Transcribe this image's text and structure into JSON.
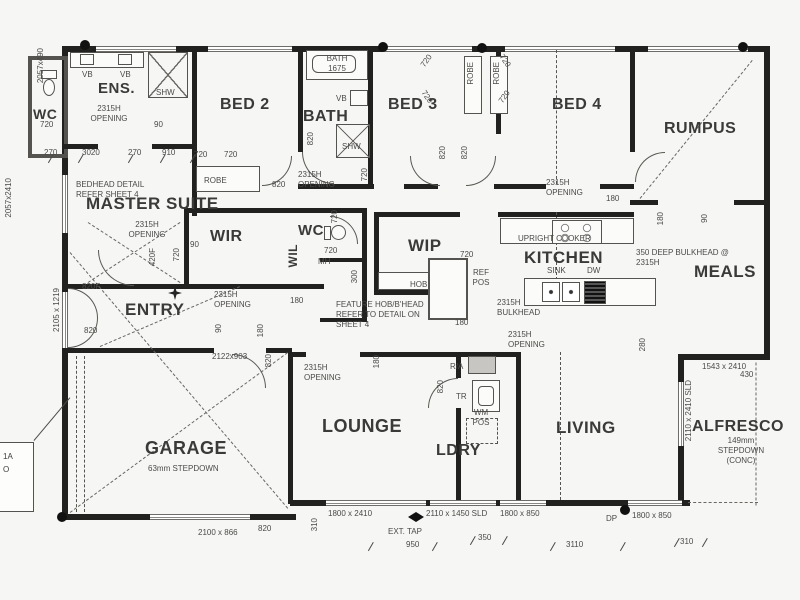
{
  "drawing": {
    "type": "residential floor plan",
    "colors": {
      "paper": "#f6f6f4",
      "wall": "#21211f",
      "text": "#3d3d3d",
      "thin_line": "#55534f"
    }
  },
  "rooms": {
    "wc1": {
      "label": "WC"
    },
    "ens": {
      "label": "ENS."
    },
    "bed2": {
      "label": "BED 2"
    },
    "bath": {
      "label": "BATH"
    },
    "bed3": {
      "label": "BED 3"
    },
    "bed4": {
      "label": "BED 4"
    },
    "rumpus": {
      "label": "RUMPUS"
    },
    "master": {
      "label": "MASTER SUITE"
    },
    "wir": {
      "label": "WIR"
    },
    "wc2": {
      "label": "WC"
    },
    "wil": {
      "label": "WIL"
    },
    "wip": {
      "label": "WIP"
    },
    "kitchen": {
      "label": "KITCHEN"
    },
    "meals": {
      "label": "MEALS"
    },
    "entry": {
      "label": "ENTRY"
    },
    "garage": {
      "label": "GARAGE"
    },
    "lounge": {
      "label": "LOUNGE"
    },
    "ldry": {
      "label": "LDRY"
    },
    "living": {
      "label": "LIVING"
    },
    "alfresco": {
      "label": "ALFRESCO"
    }
  },
  "edge_note": {
    "line1": "1A",
    "line2": "O"
  },
  "annotations": [
    {
      "id": "dim-2057x490",
      "text": "2057x490",
      "x": 36,
      "y": 48,
      "vert": true
    },
    {
      "id": "vb-ens-1",
      "text": "VB",
      "x": 82,
      "y": 70
    },
    {
      "id": "vb-ens-2",
      "text": "VB",
      "x": 120,
      "y": 70
    },
    {
      "id": "shw-ens",
      "text": "SHW",
      "x": 156,
      "y": 88
    },
    {
      "id": "dim-720-wc1",
      "text": "720",
      "x": 40,
      "y": 120
    },
    {
      "id": "opening-ens",
      "text": "2315H\nOPENING",
      "x": 80,
      "y": 104,
      "w": 58,
      "align": "center"
    },
    {
      "id": "dim-90-ens",
      "text": "90",
      "x": 154,
      "y": 120
    },
    {
      "id": "dim-270a",
      "text": "270",
      "x": 44,
      "y": 148
    },
    {
      "id": "dim-3020",
      "text": "3020",
      "x": 82,
      "y": 148
    },
    {
      "id": "dim-270b",
      "text": "270",
      "x": 128,
      "y": 148
    },
    {
      "id": "dim-910",
      "text": "910",
      "x": 162,
      "y": 148
    },
    {
      "id": "note-bedhead",
      "text": "BEDHEAD DETAIL\nREFER SHEET 4",
      "x": 76,
      "y": 180,
      "w": 90
    },
    {
      "id": "dim-2057x2410",
      "text": "2057x2410",
      "x": 4,
      "y": 178,
      "vert": true
    },
    {
      "id": "dim-720-robe2a",
      "text": "720",
      "x": 194,
      "y": 150
    },
    {
      "id": "dim-720-robe2b",
      "text": "720",
      "x": 224,
      "y": 150
    },
    {
      "id": "robe-bed2",
      "text": "ROBE",
      "x": 204,
      "y": 176
    },
    {
      "id": "dim-820-bed2",
      "text": "820",
      "x": 272,
      "y": 180
    },
    {
      "id": "bath-tub-label",
      "text": "BATH\n1675",
      "x": 316,
      "y": 54,
      "w": 42,
      "align": "center"
    },
    {
      "id": "vb-bath",
      "text": "VB",
      "x": 336,
      "y": 94
    },
    {
      "id": "shw-bath",
      "text": "SHW",
      "x": 342,
      "y": 142
    },
    {
      "id": "dim-820-bath",
      "text": "820",
      "x": 306,
      "y": 132,
      "vert": true
    },
    {
      "id": "opening-bath",
      "text": "2315H\nOPENING",
      "x": 298,
      "y": 170,
      "w": 58
    },
    {
      "id": "dim-720-bath",
      "text": "720",
      "x": 360,
      "y": 168,
      "vert": true
    },
    {
      "id": "dim-720-robe3a",
      "text": "720",
      "x": 420,
      "y": 56,
      "rot": -55
    },
    {
      "id": "dim-720-robe3b",
      "text": "720",
      "x": 420,
      "y": 92,
      "rot": 55
    },
    {
      "id": "dim-720-robe4a",
      "text": "720",
      "x": 498,
      "y": 56,
      "rot": 55
    },
    {
      "id": "dim-720-robe4b",
      "text": "720",
      "x": 498,
      "y": 92,
      "rot": -55
    },
    {
      "id": "robe-bed3",
      "text": "ROBE",
      "x": 466,
      "y": 62,
      "vert": true
    },
    {
      "id": "robe-bed4",
      "text": "ROBE",
      "x": 492,
      "y": 62,
      "vert": true
    },
    {
      "id": "dim-820-bed3",
      "text": "820",
      "x": 438,
      "y": 146,
      "vert": true
    },
    {
      "id": "dim-820-bed4",
      "text": "820",
      "x": 460,
      "y": 146,
      "vert": true
    },
    {
      "id": "opening-bed4",
      "text": "2315H\nOPENING",
      "x": 546,
      "y": 178,
      "w": 58
    },
    {
      "id": "dim-180-rumpus",
      "text": "180",
      "x": 606,
      "y": 194
    },
    {
      "id": "dim-180-meals",
      "text": "180",
      "x": 656,
      "y": 212,
      "vert": true
    },
    {
      "id": "dim-90-meals",
      "text": "90",
      "x": 700,
      "y": 214,
      "vert": true
    },
    {
      "id": "note-bulkhead-meals",
      "text": "350 DEEP BULKHEAD @\n2315H",
      "x": 636,
      "y": 248,
      "w": 120
    },
    {
      "id": "dim-280",
      "text": "280",
      "x": 638,
      "y": 338,
      "vert": true
    },
    {
      "id": "opening-master",
      "text": "2315H\nOPENING",
      "x": 116,
      "y": 220,
      "w": 62,
      "align": "center"
    },
    {
      "id": "dim-420f",
      "text": "420F",
      "x": 148,
      "y": 248,
      "vert": true
    },
    {
      "id": "dim-720-master",
      "text": "720",
      "x": 172,
      "y": 248,
      "vert": true
    },
    {
      "id": "dim-820f-master",
      "text": "820F",
      "x": 82,
      "y": 282
    },
    {
      "id": "dim-820-master",
      "text": "820",
      "x": 84,
      "y": 326
    },
    {
      "id": "dim-2105x1219",
      "text": "2105 x 1219",
      "x": 52,
      "y": 288,
      "vert": true
    },
    {
      "id": "dim-90-wir",
      "text": "90",
      "x": 190,
      "y": 240
    },
    {
      "id": "opening-wir",
      "text": "2315H\nOPENING",
      "x": 214,
      "y": 290,
      "w": 60
    },
    {
      "id": "dim-90-entry",
      "text": "90",
      "x": 214,
      "y": 324,
      "vert": true
    },
    {
      "id": "dim-180-entry",
      "text": "180",
      "x": 256,
      "y": 324,
      "vert": true
    },
    {
      "id": "dim-2122x903",
      "text": "2122x903",
      "x": 212,
      "y": 352
    },
    {
      "id": "dim-820-entry",
      "text": "820",
      "x": 264,
      "y": 354,
      "vert": true
    },
    {
      "id": "dim-720-wc2",
      "text": "720",
      "x": 330,
      "y": 210,
      "vert": true
    },
    {
      "id": "dim-720-wil",
      "text": "720",
      "x": 324,
      "y": 246
    },
    {
      "id": "mh-label",
      "text": "MH",
      "x": 318,
      "y": 257
    },
    {
      "id": "dim-300-wil",
      "text": "300",
      "x": 350,
      "y": 270,
      "vert": true
    },
    {
      "id": "dim-180-hall",
      "text": "180",
      "x": 290,
      "y": 296
    },
    {
      "id": "note-feature-hob",
      "text": "FEATURE HOB/B'HEAD\nREFER TO DETAIL ON\nSHEET 4",
      "x": 336,
      "y": 300,
      "w": 104
    },
    {
      "id": "dim-720-wip",
      "text": "720",
      "x": 460,
      "y": 250
    },
    {
      "id": "hob-label",
      "text": "HOB",
      "x": 410,
      "y": 280
    },
    {
      "id": "ref-pos-label",
      "text": "REF\nPOS",
      "x": 468,
      "y": 268,
      "w": 26,
      "align": "center"
    },
    {
      "id": "note-bulkhead-kitchen",
      "text": "2315H\nBULKHEAD",
      "x": 497,
      "y": 298,
      "w": 60
    },
    {
      "id": "dim-180-kitchen",
      "text": "180",
      "x": 455,
      "y": 318
    },
    {
      "id": "opening-kitchen",
      "text": "2315H\nOPENING",
      "x": 508,
      "y": 330,
      "w": 58
    },
    {
      "id": "upright-cooker",
      "text": "UPRIGHT COOKER",
      "x": 518,
      "y": 234
    },
    {
      "id": "sink-label",
      "text": "SINK",
      "x": 547,
      "y": 266
    },
    {
      "id": "dw-label",
      "text": "DW",
      "x": 587,
      "y": 266
    },
    {
      "id": "ra-label",
      "text": "R/A",
      "x": 450,
      "y": 362
    },
    {
      "id": "tr-label",
      "text": "TR",
      "x": 456,
      "y": 392
    },
    {
      "id": "wm-pos",
      "text": "WM\nPOS",
      "x": 466,
      "y": 408,
      "w": 30,
      "align": "center"
    },
    {
      "id": "dim-820-ldry",
      "text": "820",
      "x": 436,
      "y": 380,
      "vert": true
    },
    {
      "id": "opening-lounge",
      "text": "2315H\nOPENING",
      "x": 304,
      "y": 363,
      "w": 56
    },
    {
      "id": "dim-180-lounge",
      "text": "180",
      "x": 372,
      "y": 355,
      "vert": true
    },
    {
      "id": "garage-stepdown",
      "text": "63mm STEPDOWN",
      "x": 148,
      "y": 464
    },
    {
      "id": "alfresco-dims",
      "text": "1543 x 2410",
      "x": 702,
      "y": 362
    },
    {
      "id": "dim-430",
      "text": "430",
      "x": 740,
      "y": 370
    },
    {
      "id": "dim-2110x2410-sld",
      "text": "2110 x 2410 SLD",
      "x": 684,
      "y": 380,
      "vert": true
    },
    {
      "id": "alfresco-stepdown",
      "text": "149mm\nSTEPDOWN\n(CONC)",
      "x": 708,
      "y": 436,
      "w": 66,
      "align": "center"
    },
    {
      "id": "dim-2100x866",
      "text": "2100 x 866",
      "x": 198,
      "y": 528
    },
    {
      "id": "dim-820-garage",
      "text": "820",
      "x": 258,
      "y": 524
    },
    {
      "id": "dim-310-left",
      "text": "310",
      "x": 310,
      "y": 518,
      "vert": true
    },
    {
      "id": "dim-1800x2410",
      "text": "1800 x 2410",
      "x": 328,
      "y": 509
    },
    {
      "id": "dim-2110x1450",
      "text": "2110 x 1450 SLD",
      "x": 426,
      "y": 509
    },
    {
      "id": "dim-1800x850-a",
      "text": "1800 x 850",
      "x": 500,
      "y": 509
    },
    {
      "id": "ext-tap",
      "text": "EXT. TAP",
      "x": 388,
      "y": 527
    },
    {
      "id": "dim-950",
      "text": "950",
      "x": 406,
      "y": 540
    },
    {
      "id": "dim-350",
      "text": "350",
      "x": 478,
      "y": 533
    },
    {
      "id": "dp-label",
      "text": "DP",
      "x": 606,
      "y": 514
    },
    {
      "id": "dim-1800x850-b",
      "text": "1800 x 850",
      "x": 632,
      "y": 511
    },
    {
      "id": "dim-3110",
      "text": "3110",
      "x": 566,
      "y": 540
    },
    {
      "id": "dim-310-b",
      "text": "310",
      "x": 680,
      "y": 537
    }
  ]
}
